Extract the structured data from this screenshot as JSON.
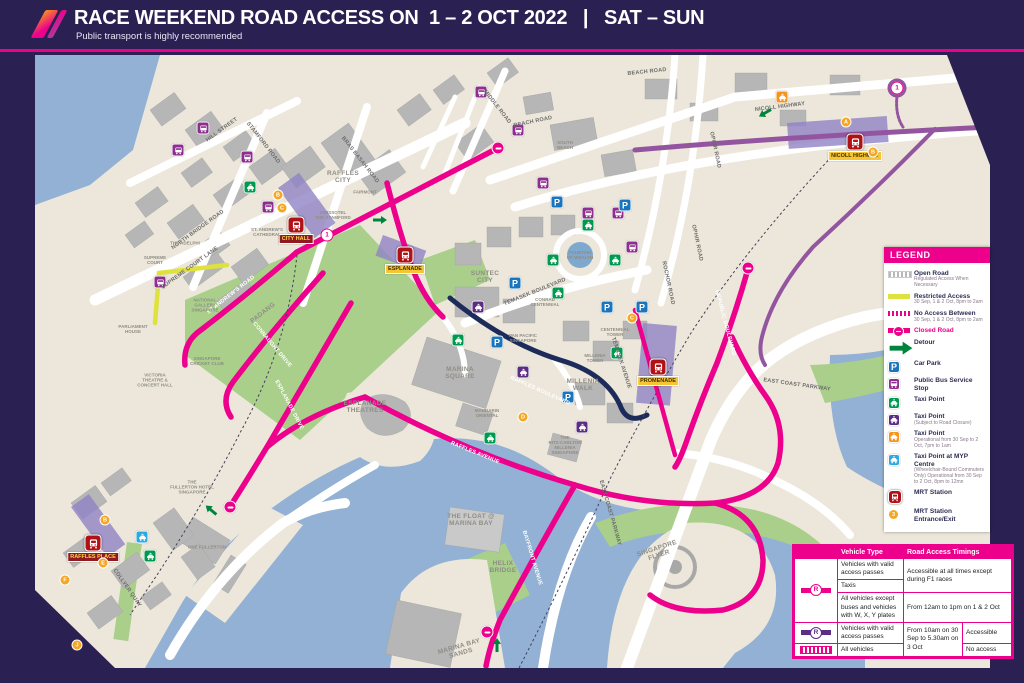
{
  "header": {
    "title": "RACE WEEKEND ROAD ACCESS ON  1 – 2 OCT 2022   |   SAT – SUN",
    "subtitle": "Public transport is highly recommended"
  },
  "colors": {
    "accent_magenta": "#ec008c",
    "background_navy": "#2a2052",
    "restricted_yellow": "#dfe23c",
    "purple_road": "#9455a0",
    "no_access_navy": "#1d2b5a",
    "water_blue": "#92b1d4",
    "park_green": "#a9cf8b",
    "mrt_red": "#b01116",
    "bus_purple": "#8e2e8e",
    "taxi_green": "#009a4e",
    "taxi_purple": "#5c2d83",
    "taxi_orange": "#f7941d",
    "taxi_blue": "#29abe2",
    "carpark_blue": "#1b75bc",
    "exit_orange": "#f5a623"
  },
  "legend": {
    "title": "LEGEND",
    "items": [
      {
        "type": "open-road",
        "label": "Open Road",
        "sub": "Regulated Access When Necessary"
      },
      {
        "type": "restricted",
        "label": "Restricted Access",
        "sub": "30 Sep, 1 & 2 Oct, 8pm to 2am"
      },
      {
        "type": "no-access",
        "label": "No Access Between",
        "sub": "30 Sep, 1 & 2 Oct, 8pm to 2am"
      },
      {
        "type": "closed-road",
        "label": "Closed Road",
        "sub": "",
        "pink": true
      },
      {
        "type": "detour",
        "label": "Detour",
        "sub": ""
      },
      {
        "type": "carpark",
        "label": "Car Park",
        "sub": ""
      },
      {
        "type": "bus",
        "label": "Public Bus Service Stop",
        "sub": ""
      },
      {
        "type": "taxi-green",
        "label": "Taxi Point",
        "sub": ""
      },
      {
        "type": "taxi-purple",
        "label": "Taxi Point",
        "sub": "(Subject to Road Closure)"
      },
      {
        "type": "taxi-orange",
        "label": "Taxi Point",
        "sub": "Operational from 30 Sep to 2 Oct, 7pm to 1am"
      },
      {
        "type": "taxi-blue",
        "label": "Taxi Point at MYP Centre",
        "sub": "(Wheelchair-Bound Commuters Only) Operational from 30 Sep to 2 Oct, 8pm to 12mn"
      },
      {
        "type": "mrt",
        "label": "MRT Station",
        "sub": ""
      },
      {
        "type": "exit",
        "label": "MRT Station Entrance/Exit",
        "sub": ""
      }
    ]
  },
  "table": {
    "header_vehicle": "Vehicle Type",
    "header_timing": "Road Access Timings",
    "r1a_vehicle": "Vehicles with valid access passes",
    "r1b_vehicle": "Taxis",
    "r1_timing": "Accessible at all times except during F1 races",
    "r2_vehicle": "All vehicles except buses and vehicles with W, X, Y plates",
    "r2_timing": "From 12am to 1pm on 1 & 2 Oct",
    "r3_vehicle": "Vehicles with valid access passes",
    "r3_timing": "From 10am on 30 Sep to 5.30am on 3 Oct",
    "r3_access": "Accessible",
    "r4_vehicle": "All vehicles",
    "r4_access": "No access"
  },
  "map": {
    "stations": [
      {
        "name": "CITY HALL",
        "x": 261,
        "y": 170,
        "style": "red"
      },
      {
        "name": "ESPLANADE",
        "x": 370,
        "y": 200,
        "style": "yellow"
      },
      {
        "name": "PROMENADE",
        "x": 623,
        "y": 312,
        "style": "yellow"
      },
      {
        "name": "NICOLL HIGHWAY",
        "x": 820,
        "y": 87,
        "style": "yellow"
      },
      {
        "name": "RAFFLES PLACE",
        "x": 58,
        "y": 488,
        "style": "red"
      }
    ],
    "road_labels": [
      {
        "text": "HILL STREET",
        "x": 187,
        "y": 75,
        "rot": -36
      },
      {
        "text": "STAMFORD ROAD",
        "x": 228,
        "y": 88,
        "rot": 52
      },
      {
        "text": "NORTH BRIDGE ROAD",
        "x": 163,
        "y": 175,
        "rot": -36
      },
      {
        "text": "BRAS BASAH ROAD",
        "x": 325,
        "y": 105,
        "rot": 52
      },
      {
        "text": "MIDDLE ROAD",
        "x": 462,
        "y": 52,
        "rot": 52
      },
      {
        "text": "BEACH ROAD",
        "x": 498,
        "y": 67,
        "rot": -12
      },
      {
        "text": "BEACH ROAD",
        "x": 612,
        "y": 17,
        "rot": -6
      },
      {
        "text": "NICOLL HIGHWAY",
        "x": 745,
        "y": 52,
        "rot": -7
      },
      {
        "text": "OPHIR ROAD",
        "x": 680,
        "y": 95,
        "rot": 78
      },
      {
        "text": "OPHIR ROAD",
        "x": 662,
        "y": 188,
        "rot": 78
      },
      {
        "text": "ROCHOR ROAD",
        "x": 633,
        "y": 228,
        "rot": 78
      },
      {
        "text": "TEMASEK BOULEVARD",
        "x": 500,
        "y": 237,
        "rot": -22
      },
      {
        "text": "TEMASEK AVENUE",
        "x": 586,
        "y": 308,
        "rot": 72
      },
      {
        "text": "RAFFLES BOULEVARD",
        "x": 505,
        "y": 336,
        "rot": 24,
        "onroad": true
      },
      {
        "text": "RAFFLES AVENUE",
        "x": 440,
        "y": 398,
        "rot": 22,
        "onroad": true
      },
      {
        "text": "ESPLANADE DRIVE",
        "x": 254,
        "y": 350,
        "rot": 62,
        "onroad": true
      },
      {
        "text": "CONNAUGHT DRIVE",
        "x": 237,
        "y": 290,
        "rot": 50,
        "onroad": true
      },
      {
        "text": "ST ANDREW'S ROAD",
        "x": 196,
        "y": 240,
        "rot": -38,
        "onroad": true
      },
      {
        "text": "SUPREME COURT LANE",
        "x": 155,
        "y": 213,
        "rot": -36
      },
      {
        "text": "COLLYER QUAY",
        "x": 92,
        "y": 533,
        "rot": 55
      },
      {
        "text": "EAST COAST PARKWAY",
        "x": 575,
        "y": 458,
        "rot": 74
      },
      {
        "text": "EAST COAST PARKWAY",
        "x": 762,
        "y": 330,
        "rot": 8
      },
      {
        "text": "BAYFRONT AVENUE",
        "x": 497,
        "y": 503,
        "rot": 73,
        "onroad": true
      },
      {
        "text": "REPUBLIC BOULEVARD",
        "x": 690,
        "y": 268,
        "rot": 75,
        "onroad": true
      }
    ],
    "area_labels": [
      {
        "text": "RAFFLES\nCITY",
        "x": 308,
        "y": 122,
        "rot": 0
      },
      {
        "text": "SUNTEC\nCITY",
        "x": 450,
        "y": 222,
        "rot": 0
      },
      {
        "text": "MARINA\nSQUARE",
        "x": 425,
        "y": 318,
        "rot": 0
      },
      {
        "text": "MILLENIA\nWALK",
        "x": 548,
        "y": 330,
        "rot": 0
      },
      {
        "text": "ESPLANADE\nTHEATRES",
        "x": 330,
        "y": 352,
        "rot": 0
      },
      {
        "text": "PADANG",
        "x": 228,
        "y": 258,
        "rot": -38
      },
      {
        "text": "SINGAPORE\nFLYER",
        "x": 623,
        "y": 497,
        "rot": -18
      },
      {
        "text": "MARINA BAY\nSANDS",
        "x": 425,
        "y": 595,
        "rot": -16
      },
      {
        "text": "THE FLOAT @\nMARINA BAY",
        "x": 436,
        "y": 465,
        "rot": 0
      },
      {
        "text": "HELIX\nBRIDGE",
        "x": 468,
        "y": 512,
        "rot": 0
      }
    ],
    "building_labels": [
      {
        "text": "SUPREME\nCOURT",
        "x": 120,
        "y": 205
      },
      {
        "text": "NATIONAL\nGALLERY\nSINGAPORE",
        "x": 170,
        "y": 250
      },
      {
        "text": "PARLIAMENT\nHOUSE",
        "x": 98,
        "y": 274
      },
      {
        "text": "VICTORIA\nTHEATRE &\nCONCERT HALL",
        "x": 120,
        "y": 325
      },
      {
        "text": "SINGAPORE\nCRICKET CLUB",
        "x": 172,
        "y": 306
      },
      {
        "text": "ST. ANDREW'S\nCATHEDRAL",
        "x": 232,
        "y": 177
      },
      {
        "text": "THE ADELPHI",
        "x": 150,
        "y": 188
      },
      {
        "text": "FAIRMONT",
        "x": 330,
        "y": 137
      },
      {
        "text": "SWISSOTEL\nTHE STAMFORD",
        "x": 298,
        "y": 160
      },
      {
        "text": "SOUTH\nBEACH",
        "x": 530,
        "y": 90
      },
      {
        "text": "PAN PACIFIC\nSINGAPORE",
        "x": 488,
        "y": 283
      },
      {
        "text": "CONRAD\nCENTENNIAL",
        "x": 510,
        "y": 247
      },
      {
        "text": "CENTENNIAL\nTOWER",
        "x": 580,
        "y": 277
      },
      {
        "text": "MILLENIA\nTOWER",
        "x": 560,
        "y": 303
      },
      {
        "text": "MANDARIN\nORIENTAL",
        "x": 452,
        "y": 358
      },
      {
        "text": "THE\nRITZ-CARLTON\nMILLENIA\nSINGAPORE",
        "x": 530,
        "y": 390
      },
      {
        "text": "THE\nFULLERTON HOTEL\nSINGAPORE",
        "x": 157,
        "y": 432
      },
      {
        "text": "ONE FULLERTON",
        "x": 172,
        "y": 492
      },
      {
        "text": "FOUNTAIN\nOF WEALTH",
        "x": 545,
        "y": 200
      }
    ],
    "icons": [
      {
        "type": "bus",
        "x": 168,
        "y": 73
      },
      {
        "type": "bus",
        "x": 143,
        "y": 95
      },
      {
        "type": "bus",
        "x": 212,
        "y": 102
      },
      {
        "type": "bus",
        "x": 233,
        "y": 152
      },
      {
        "type": "bus",
        "x": 125,
        "y": 227
      },
      {
        "type": "bus",
        "x": 446,
        "y": 37
      },
      {
        "type": "bus",
        "x": 483,
        "y": 75
      },
      {
        "type": "bus",
        "x": 508,
        "y": 128
      },
      {
        "type": "bus",
        "x": 553,
        "y": 158
      },
      {
        "type": "bus",
        "x": 583,
        "y": 158
      },
      {
        "type": "bus",
        "x": 597,
        "y": 192
      },
      {
        "type": "taxi-green",
        "x": 215,
        "y": 132
      },
      {
        "type": "taxi-green",
        "x": 553,
        "y": 170
      },
      {
        "type": "taxi-green",
        "x": 518,
        "y": 205
      },
      {
        "type": "taxi-green",
        "x": 580,
        "y": 205
      },
      {
        "type": "taxi-green",
        "x": 523,
        "y": 238
      },
      {
        "type": "taxi-green",
        "x": 423,
        "y": 285
      },
      {
        "type": "taxi-green",
        "x": 582,
        "y": 298
      },
      {
        "type": "taxi-green",
        "x": 455,
        "y": 383
      },
      {
        "type": "taxi-green",
        "x": 115,
        "y": 501
      },
      {
        "type": "taxi-purple",
        "x": 443,
        "y": 252
      },
      {
        "type": "taxi-purple",
        "x": 488,
        "y": 317
      },
      {
        "type": "taxi-purple",
        "x": 547,
        "y": 372
      },
      {
        "type": "taxi-orange",
        "x": 747,
        "y": 42
      },
      {
        "type": "taxi-blue",
        "x": 107,
        "y": 482
      },
      {
        "type": "carpark",
        "x": 522,
        "y": 147
      },
      {
        "type": "carpark",
        "x": 590,
        "y": 150
      },
      {
        "type": "carpark",
        "x": 480,
        "y": 228
      },
      {
        "type": "carpark",
        "x": 572,
        "y": 252
      },
      {
        "type": "carpark",
        "x": 607,
        "y": 252
      },
      {
        "type": "carpark",
        "x": 462,
        "y": 287
      },
      {
        "type": "carpark",
        "x": 533,
        "y": 342
      }
    ],
    "exits": [
      {
        "letter": "A",
        "x": 811,
        "y": 67
      },
      {
        "letter": "B",
        "x": 838,
        "y": 97
      },
      {
        "letter": "B",
        "x": 243,
        "y": 140
      },
      {
        "letter": "C",
        "x": 247,
        "y": 153
      },
      {
        "letter": "C",
        "x": 597,
        "y": 263
      },
      {
        "letter": "D",
        "x": 488,
        "y": 362
      },
      {
        "letter": "B",
        "x": 70,
        "y": 465
      },
      {
        "letter": "E",
        "x": 68,
        "y": 508
      },
      {
        "letter": "F",
        "x": 30,
        "y": 525
      },
      {
        "letter": "J",
        "x": 42,
        "y": 590
      }
    ],
    "no_entry": [
      {
        "x": 463,
        "y": 93
      },
      {
        "x": 195,
        "y": 452
      },
      {
        "x": 452,
        "y": 577
      },
      {
        "x": 713,
        "y": 213
      }
    ],
    "route_markers": [
      {
        "n": "1",
        "x": 862,
        "y": 33
      },
      {
        "n": "1",
        "x": 292,
        "y": 180
      }
    ],
    "detours": [
      {
        "x": 345,
        "y": 165,
        "rot": 0
      },
      {
        "x": 730,
        "y": 58,
        "rot": 150
      },
      {
        "x": 176,
        "y": 455,
        "rot": -140
      },
      {
        "x": 462,
        "y": 590,
        "rot": -90
      }
    ]
  }
}
